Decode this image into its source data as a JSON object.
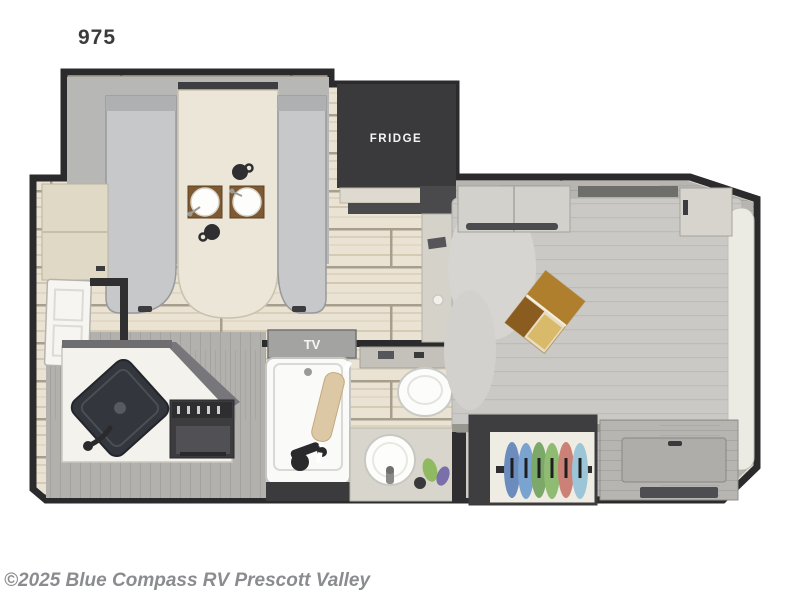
{
  "page": {
    "background": "#ffffff",
    "plan_number": "975",
    "copyright": "©2025 Blue Compass RV Prescott Valley"
  },
  "floorplan": {
    "labels": {
      "fridge": "FRIDGE",
      "tv": "TV"
    },
    "colors": {
      "wall": "#2b2b2d",
      "appliance_dark": "#3a3a3c",
      "floor_plank": "#eae3d4",
      "floor_seam": "#a79e8b",
      "slide_floor": "#b7b8b6",
      "bench": "#c6c8ca",
      "table": "#ece6d8",
      "bed": "#cac9c5",
      "pillow": "#ecebe3",
      "counter_white": "#f4f2ec",
      "cabinet_cream": "#e0d9c6",
      "gray_wood": "#b6b5b1",
      "sink_dark": "#33363c",
      "tub_white": "#fafaf8",
      "magazine_gold": "#b07f2e"
    },
    "closet_clothes": [
      "#6b8cbd",
      "#7ba3d0",
      "#7ca96a",
      "#8fbc72",
      "#cc8177",
      "#9cc6d8"
    ]
  }
}
